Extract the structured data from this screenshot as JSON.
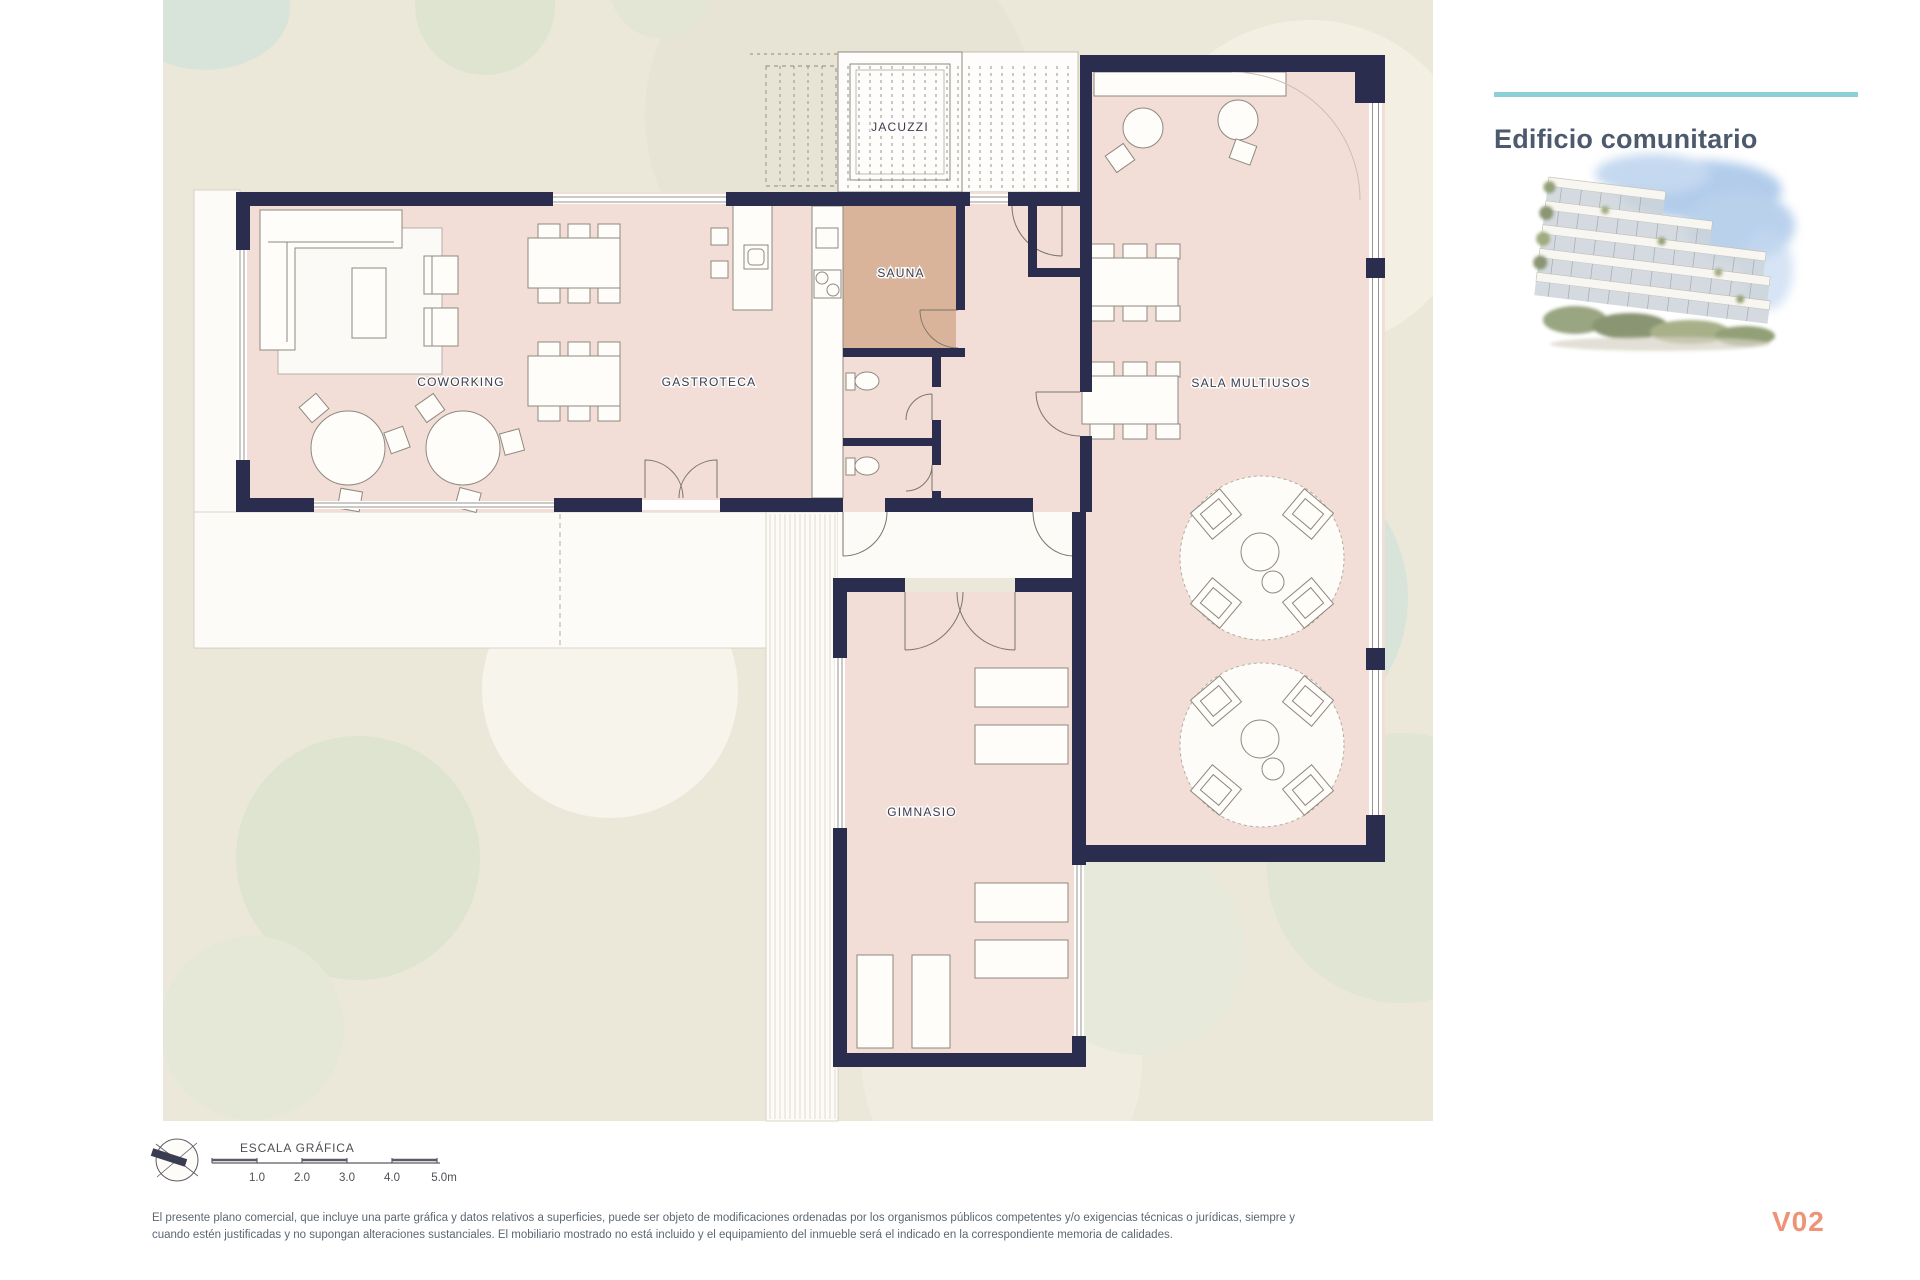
{
  "header": {
    "title": "Edificio comunitario"
  },
  "plan": {
    "rooms": [
      {
        "id": "jacuzzi",
        "label": "JACUZZI"
      },
      {
        "id": "sauna",
        "label": "SAUNA"
      },
      {
        "id": "coworking",
        "label": "COWORKING"
      },
      {
        "id": "gastroteca",
        "label": "GASTROTECA"
      },
      {
        "id": "sala-multiusos",
        "label": "SALA MULTIUSOS"
      },
      {
        "id": "gimnasio",
        "label": "GIMNASIO"
      }
    ]
  },
  "scale_bar": {
    "title": "ESCALA GRÁFICA",
    "ticks": [
      "1.0",
      "2.0",
      "3.0",
      "4.0",
      "5.0m"
    ]
  },
  "footer": {
    "disclaimer_line1": "El presente plano comercial, que incluye una parte gráfica y datos relativos a superficies, puede ser objeto de modificaciones ordenadas por los organismos públicos competentes y/o exigencias técnicas o jurídicas, siempre y",
    "disclaimer_line2": "cuando estén justificadas y no supongan alteraciones sustanciales. El mobiliario mostrado no está incluido y el equipamiento del inmueble será el indicado en la correspondiente memoria de calidades.",
    "version": "V02"
  },
  "colors": {
    "accent_teal": "#8bd0d5",
    "wall_navy": "#2b2d4e",
    "floor_pink": "#f2ded7",
    "sauna_tan": "#d9b49b",
    "background_beige": "#ebe8d9",
    "title_slate": "#4d5a6e",
    "version_coral": "#ef9377"
  }
}
